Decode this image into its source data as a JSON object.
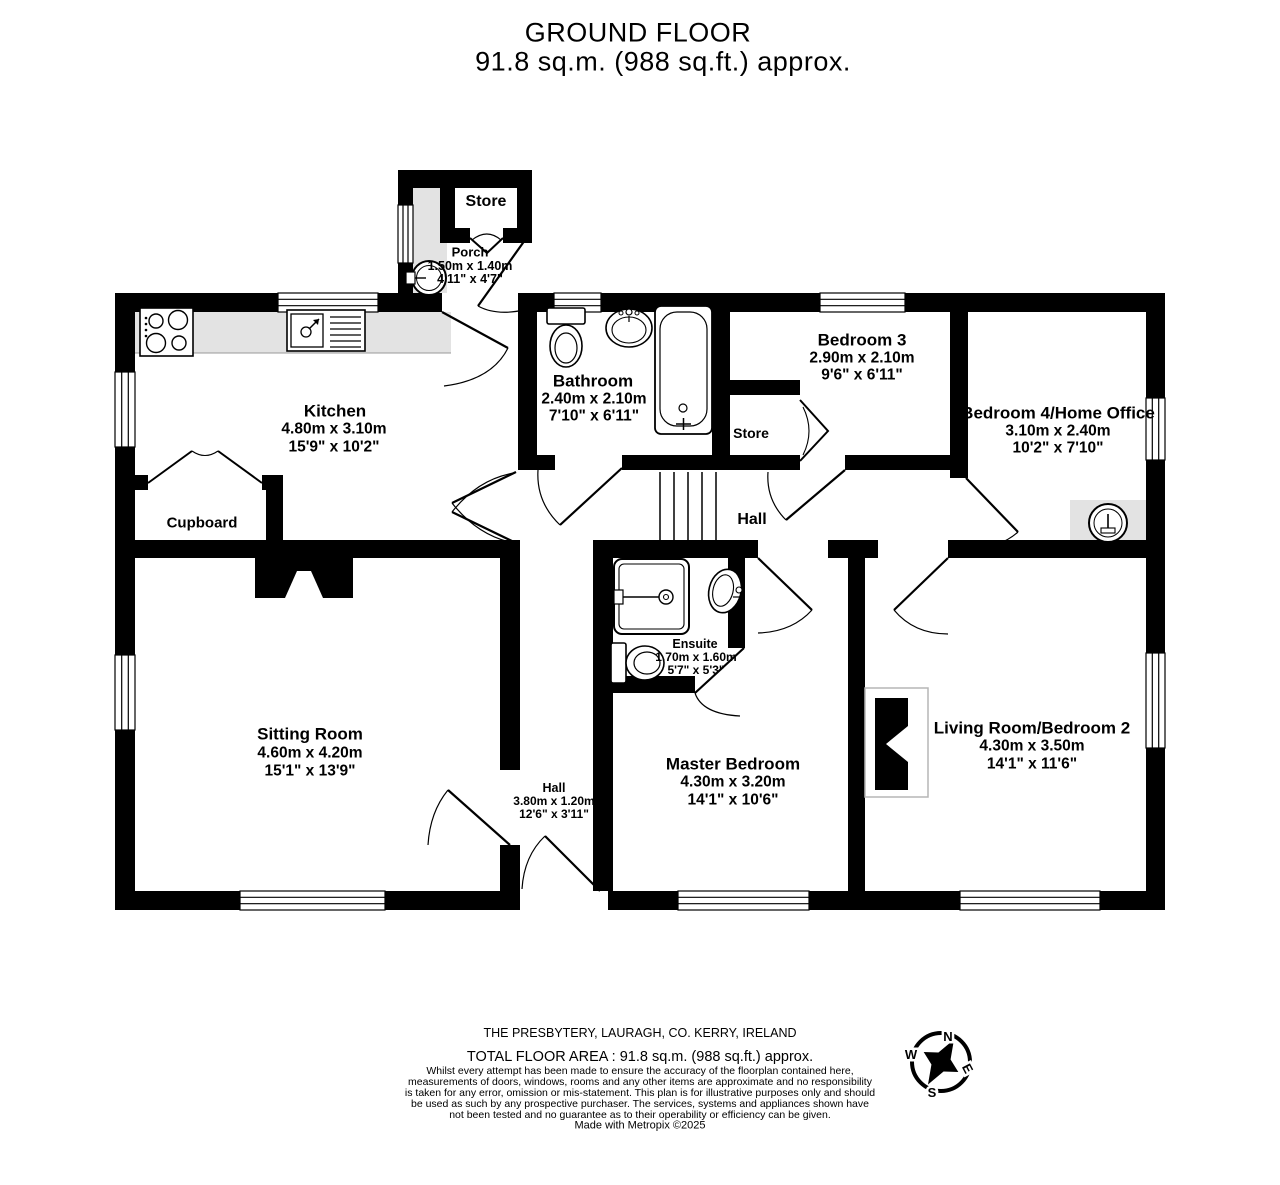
{
  "title": {
    "line1": "GROUND FLOOR",
    "line2": "91.8 sq.m. (988 sq.ft.) approx."
  },
  "rooms": {
    "store_porch": {
      "name": "Store"
    },
    "porch": {
      "name": "Porch",
      "metric": "1.50m  x 1.40m",
      "imperial": "4'11\"  x 4'7\""
    },
    "kitchen": {
      "name": "Kitchen",
      "metric": "4.80m  x 3.10m",
      "imperial": "15'9\"  x 10'2\""
    },
    "bathroom": {
      "name": "Bathroom",
      "metric": "2.40m  x 2.10m",
      "imperial": "7'10\"  x 6'11\""
    },
    "bedroom3": {
      "name": "Bedroom 3",
      "metric": "2.90m  x 2.10m",
      "imperial": "9'6\"  x 6'11\""
    },
    "bedroom4": {
      "name": "Bedroom 4/Home Office",
      "metric": "3.10m  x 2.40m",
      "imperial": "10'2\"  x 7'10\""
    },
    "store_hall": {
      "name": "Store"
    },
    "cupboard": {
      "name": "Cupboard"
    },
    "hall": {
      "name": "Hall"
    },
    "ensuite": {
      "name": "Ensuite",
      "metric": "1.70m  x 1.60m",
      "imperial": "5'7\"  x 5'3\""
    },
    "sitting_room": {
      "name": "Sitting Room",
      "metric": "4.60m  x 4.20m",
      "imperial": "15'1\"  x 13'9\""
    },
    "hall_lower": {
      "name": "Hall",
      "metric": "3.80m  x 1.20m",
      "imperial": "12'6\"  x 3'11\""
    },
    "master_bedroom": {
      "name": "Master Bedroom",
      "metric": "4.30m  x 3.20m",
      "imperial": "14'1\"  x 10'6\""
    },
    "living_room": {
      "name": "Living Room/Bedroom 2",
      "metric": "4.30m  x 3.50m",
      "imperial": "14'1\"  x 11'6\""
    }
  },
  "compass": {
    "north": "N",
    "east": "E",
    "south": "S",
    "west": "W"
  },
  "footer": {
    "address": "THE PRESBYTERY, LAURAGH, CO. KERRY, IRELAND",
    "total_area": "TOTAL FLOOR AREA : 91.8 sq.m. (988 sq.ft.) approx.",
    "disclaimer": "Whilst every attempt has been made to ensure the accuracy of the floorplan contained here, measurements of doors, windows, rooms and any other items are approximate and no responsibility is taken for any error, omission or mis-statement. This plan is for illustrative purposes only and should be used as such by any prospective purchaser. The services, systems and appliances shown have not been tested and no guarantee as to their operability or efficiency can be given.",
    "credit": "Made with Metropix ©2025"
  },
  "colors": {
    "wall": "#000000",
    "floor": "#ffffff",
    "shading": "#e3e3e3"
  }
}
